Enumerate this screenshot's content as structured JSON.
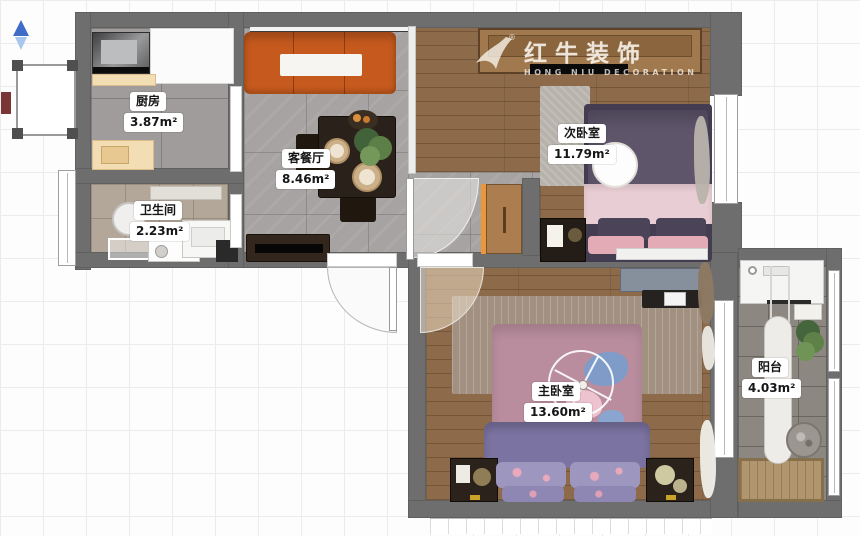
{
  "logo": {
    "brand": "红牛装饰",
    "sub": "HONG NIU DECORATION",
    "reg": "®"
  },
  "rooms": {
    "kitchen": {
      "name": "厨房",
      "area": "3.87m²"
    },
    "living": {
      "name": "客餐厅",
      "area": "8.46m²"
    },
    "bathroom": {
      "name": "卫生间",
      "area": "2.23m²"
    },
    "bedroom2": {
      "name": "次卧室",
      "area": "11.79m²"
    },
    "bedroom1": {
      "name": "主卧室",
      "area": "13.60m²"
    },
    "balcony": {
      "name": "阳台",
      "area": "4.03m²"
    }
  },
  "colors": {
    "wall": "#6e6e6e",
    "sofa_orange": "#c65a1e",
    "bed2_duvet_purple": "#5e556b",
    "bed2_blanket_pink": "#e9cdd4",
    "bed1_duvet_mauve": "#b98d9e",
    "bed1_blanket_purple": "#7b73a1",
    "wood_floor": "#8d6a49",
    "cabinet_accent_orange": "#e8973c",
    "north_arrow_blue": "#3e6cc8"
  }
}
